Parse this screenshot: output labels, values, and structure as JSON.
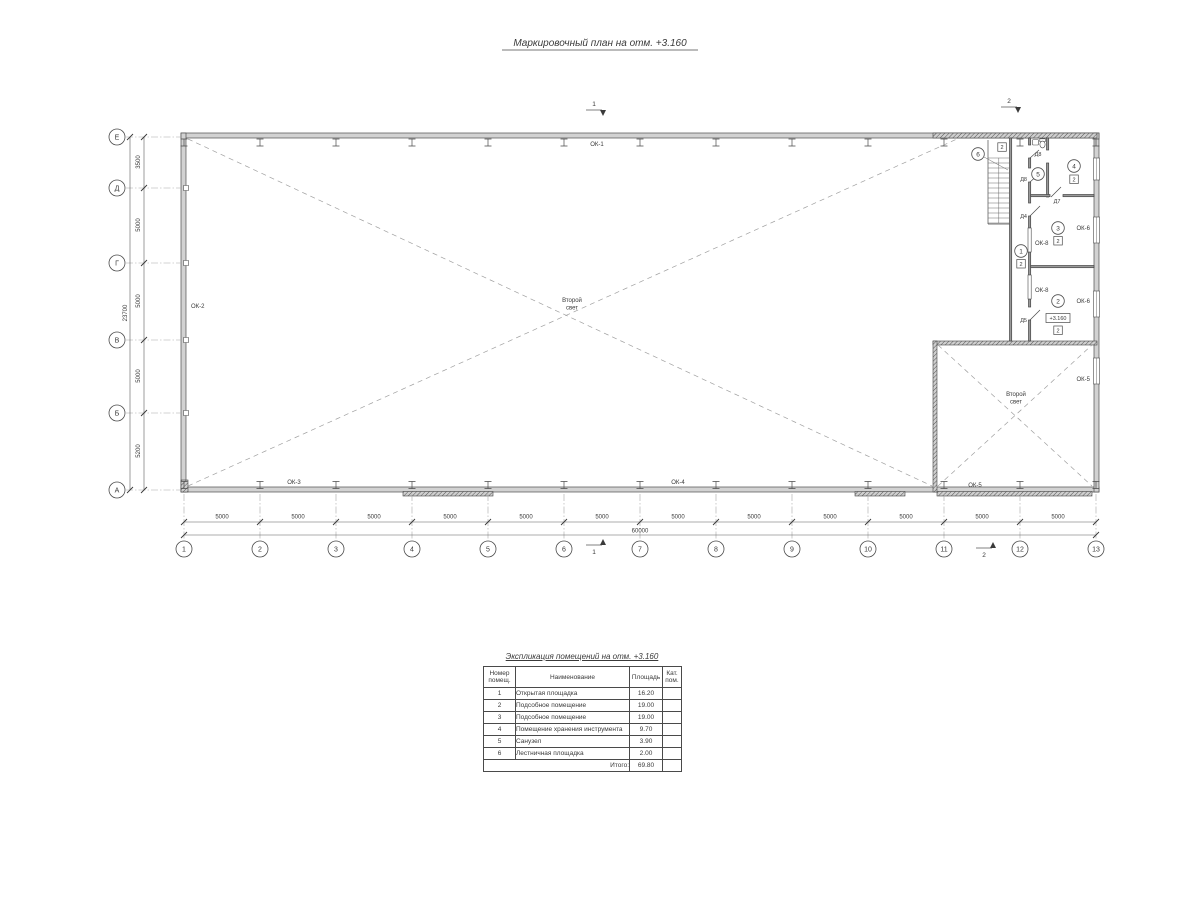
{
  "drawing": {
    "title": "Маркировочный план на отм. +3.160",
    "second_light_line1": "Второй",
    "second_light_line2": "свет",
    "elevation": "+3.160",
    "floor_type": "2"
  },
  "grid": {
    "rows": [
      "Е",
      "Д",
      "Г",
      "В",
      "Б",
      "А"
    ],
    "row_dims": [
      "3500",
      "5000",
      "5000",
      "5000",
      "5200"
    ],
    "row_total": "23700",
    "cols": [
      "1",
      "2",
      "3",
      "4",
      "5",
      "6",
      "7",
      "8",
      "9",
      "10",
      "11",
      "12",
      "13"
    ],
    "col_dim": "5000",
    "col_total": "60000"
  },
  "marks": {
    "section1": "1",
    "section2": "2",
    "windows": {
      "ok1": "ОК-1",
      "ok2": "ОК-2",
      "ok3": "ОК-3",
      "ok4": "ОК-4",
      "ok5": "ОК-5",
      "ok6": "ОК-6",
      "ok8": "ОК-8"
    },
    "doors": {
      "d4": "Д4",
      "d5": "Д5",
      "d7": "Д7",
      "d8": "Д8"
    },
    "rooms": [
      "1",
      "2",
      "3",
      "4",
      "5",
      "6"
    ]
  },
  "table": {
    "title": "Экспликация помещений на отм. +3.160",
    "headers": {
      "num": "Номер помещ.",
      "name": "Наименование",
      "area": "Площадь",
      "cat": "Кат. пом."
    },
    "rows": [
      {
        "num": "1",
        "name": "Открытая площадка",
        "area": "16.20",
        "cat": ""
      },
      {
        "num": "2",
        "name": "Подсобное помещение",
        "area": "19.00",
        "cat": ""
      },
      {
        "num": "3",
        "name": "Подсобное помещение",
        "area": "19.00",
        "cat": ""
      },
      {
        "num": "4",
        "name": "Помещение хранения инструмента",
        "area": "9.70",
        "cat": ""
      },
      {
        "num": "5",
        "name": "Санузел",
        "area": "3.90",
        "cat": ""
      },
      {
        "num": "6",
        "name": "Лестничная площадка",
        "area": "2.00",
        "cat": ""
      }
    ],
    "total_label": "Итого:",
    "total_value": "69.80"
  }
}
